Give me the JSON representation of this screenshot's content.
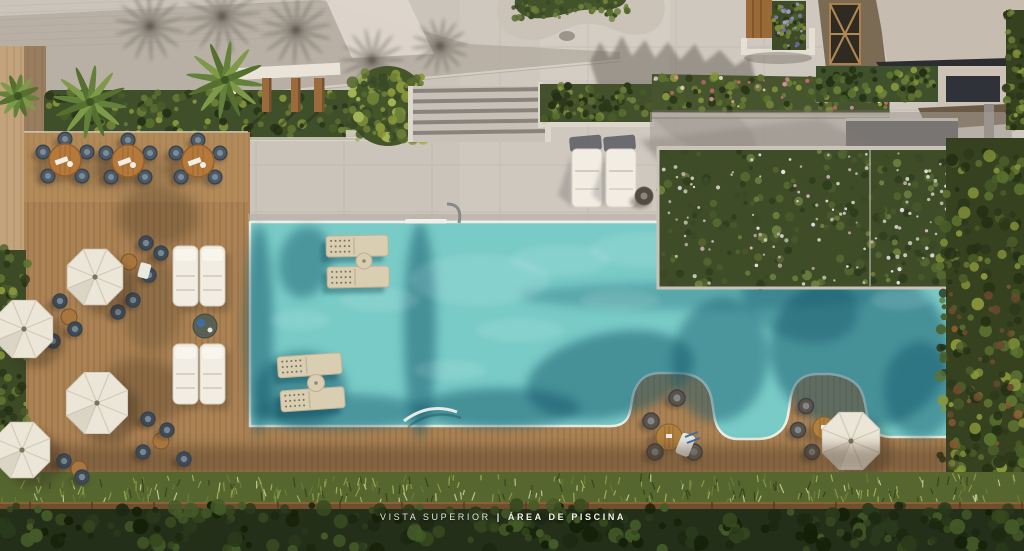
{
  "meta": {
    "image_type": "architectural-aerial-rendering",
    "subject": "rooftop swimming pool and wooden sun deck seen from directly above"
  },
  "caption": {
    "prefix": "VISTA SUPERIOR",
    "separator": "|",
    "title": "ÁREA DE PISCINA"
  },
  "palette": {
    "paving": "#cbc4bb",
    "paving_light": "#d8d2c8",
    "deck_wood": "#ab8254",
    "deck_shadow": "#4a3623",
    "pool_water": "#79cbc7",
    "pool_water_dark": "#14566a",
    "pool_coping": "#eef0e8",
    "foliage_dark": "#36421f",
    "foliage_mid": "#4a5c28",
    "foliage_light": "#88963c",
    "flower_pink": "#d9b4c0",
    "flower_white": "#e8e1e3",
    "umbrella": "#ece6d8",
    "lounger_white": "#f1ede3",
    "inpool_lounger": "#d9cdb2",
    "chair_navy": "#4e5a66",
    "table_wood": "#b5793c",
    "building_wall": "#7b6a54",
    "building_roof": "#c6bcaf",
    "canopy_dark": "#232f18",
    "caption_text": "#f5f3ee"
  },
  "scene": {
    "elements": [
      "swimming-pool",
      "wood-deck",
      "wave-shaped-deck-peninsulas",
      "parasols",
      "dining-sets",
      "chaise-lounges",
      "in-pool-loungers",
      "pool-ladder",
      "flowering-hedge-wall",
      "planters-with-palms",
      "pergola",
      "stairs",
      "rooftop-building",
      "perimeter-vegetation"
    ],
    "counts": {
      "parasols": 5,
      "dining_sets": 3,
      "deck_chaise_lounges": 4,
      "paving_loungers": 2,
      "in_pool_lounger_pairs": 2,
      "deck_peninsulas": 2
    }
  }
}
